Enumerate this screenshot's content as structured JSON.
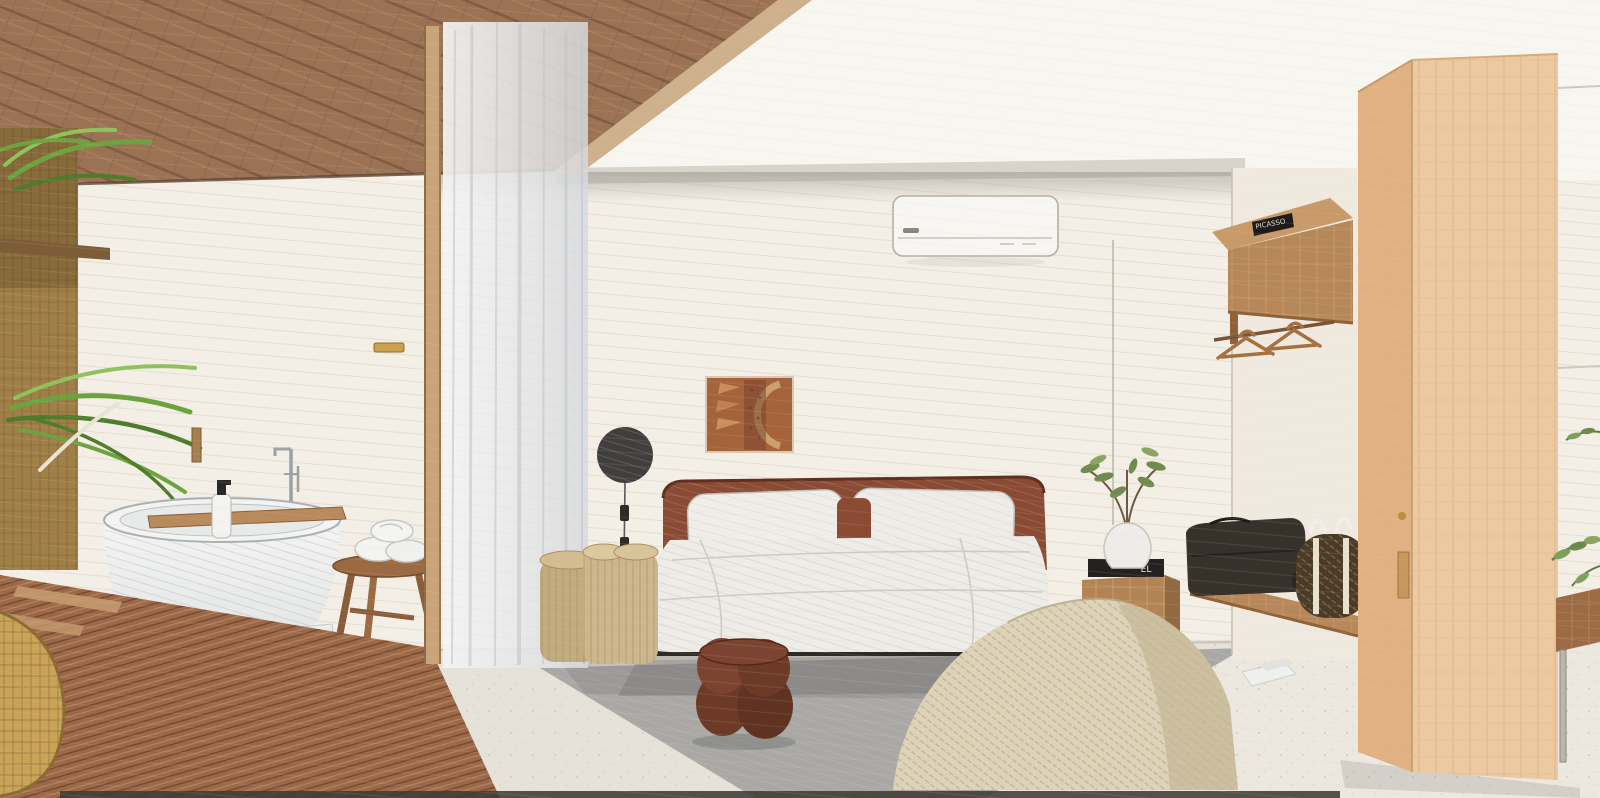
{
  "scene": {
    "kind": "interior-rendering-sketch",
    "room": "hotel bedroom suite with open bathroom, dressing area and wardrobe",
    "style": "colored-pencil / watercolor architectural sketch",
    "view": "one-point perspective, bed centered on back wall"
  },
  "texts": {
    "book_spine": "PICASSO",
    "nightstand_book_spine": "EL"
  },
  "palette": {
    "wall_offwhite": "#f4efe6",
    "ceiling_white": "#f8f6f1",
    "ceiling_wood": "#9b7254",
    "ceiling_wood_line": "#6f4e38",
    "rattan_screen": "#a08048",
    "plant_green": "#6da33f",
    "deck_wood": "#9c6847",
    "deck_plank_line": "#5f3c28",
    "concrete_floor": "#e6e2da",
    "rug_gray": "#a9a8a5",
    "tub_white": "#eceeed",
    "tray_wood": "#b98a5c",
    "curtain_gray": "#e9eaec",
    "headboard_wood": "#8a4a33",
    "linen_white": "#eeece7",
    "bed_base_black": "#2e2b27",
    "log_table": "#ccb68c",
    "lamp_black": "#413f3d",
    "artwork_rust": "#a5633c",
    "ac_white": "#f7f6f2",
    "bubble_stool": "#6e3a28",
    "beanbag_cream": "#ded3b8",
    "nightstand_wood": "#b28455",
    "wardrobe_oak": "#ecc9a0",
    "shelf_wood": "#b68758",
    "duffel_dark": "#37312b",
    "woven_bag": "#4a3a26",
    "strap_cream": "#e9e1cd"
  },
  "objects": {
    "ceiling": [
      "wood-slat-ceiling",
      "white-ceiling"
    ],
    "left_side": [
      "rattan-screen",
      "screen-shelf-plank",
      "palm-plant",
      "wicker-basket"
    ],
    "bathroom": [
      "freestanding-bathtub",
      "wood-bath-tray",
      "soap-dispenser",
      "floor-tub-filler",
      "wall-sconce",
      "wood-stool",
      "rolled-towels",
      "wood-deck-floor",
      "deck-steps",
      "step-block",
      "sheer-curtain",
      "partition-post",
      "door-handle"
    ],
    "bedroom": [
      "double-bed",
      "curved-wood-headboard",
      "two-pillows",
      "accent-cushion",
      "duvet",
      "carved-wall-art",
      "disc-wall-lamp",
      "lamp-cord-switches",
      "log-side-tables",
      "bubble-stool",
      "knitted-bean-bag",
      "air-conditioner",
      "gray-rug",
      "concrete-floor",
      "wood-nightstand",
      "stacked-books",
      "vase-with-olive-branch"
    ],
    "wardrobe_area": [
      "overhead-wood-cabinet",
      "book-on-cabinet",
      "hanging-rail",
      "two-wood-hangers",
      "floating-shelf",
      "dark-duffel-bag",
      "woven-duffel-bag",
      "tall-wardrobe-panel",
      "wardrobe-handle",
      "slipper-on-floor",
      "side-counter",
      "metal-pole",
      "plant-sprigs"
    ]
  }
}
